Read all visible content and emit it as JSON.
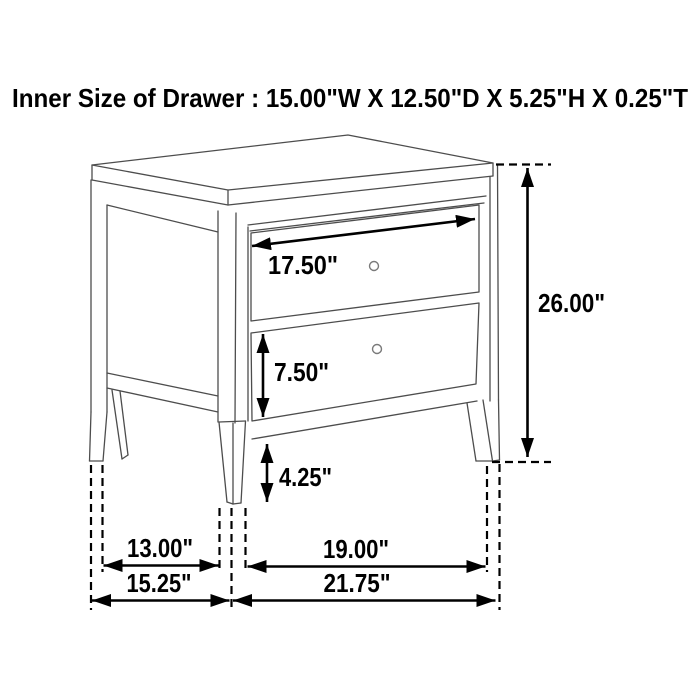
{
  "title": "Inner Size of Drawer : 15.00\"W X 12.50\"D X 5.25\"H X 0.25\"T",
  "diagram_type": "furniture-dimension-drawing",
  "subject": "two-drawer nightstand line drawing with dimension arrows",
  "dimensions": {
    "drawer_inner_width": "17.50\"",
    "overall_height": "26.00\"",
    "drawer_front_height": "7.50\"",
    "leg_clearance_height": "4.25\"",
    "side_leg_span_inner": "13.00\"",
    "side_overall_depth": "15.25\"",
    "front_leg_span_inner": "19.00\"",
    "front_overall_width": "21.75\""
  },
  "icons": {
    "drawer_knob": "small circle handle (2 drawers)"
  },
  "colors": {
    "background": "#ffffff",
    "dimension_line": "#000000",
    "furniture_line": "#4d4d4d",
    "text": "#000000"
  }
}
